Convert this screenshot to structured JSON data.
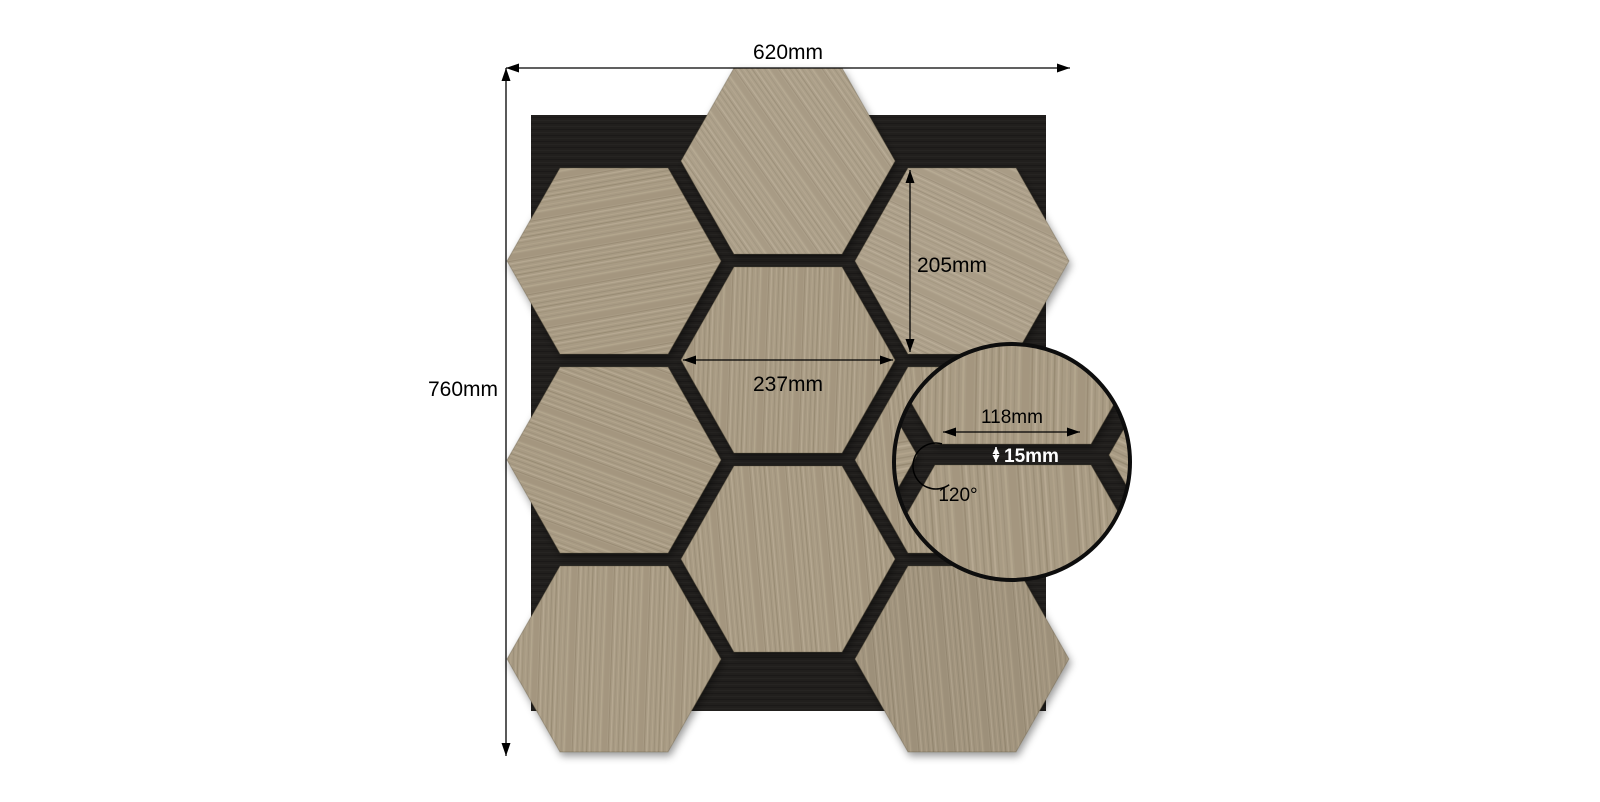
{
  "diagram": {
    "subject": "hexagon-wood-wall-panel-dimension-diagram",
    "labels": {
      "overall_width": "620mm",
      "overall_height": "760mm",
      "tile_height": "205mm",
      "tile_width": "237mm",
      "edge_length": "118mm",
      "gap_width": "15mm",
      "corner_angle": "120°"
    },
    "colors": {
      "background": "#ffffff",
      "panel_backing": "#211f1d",
      "wood_base": "#a89b84",
      "annotation_text": "#000000",
      "gap_label_text": "#ffffff"
    },
    "tile_count": 9
  }
}
